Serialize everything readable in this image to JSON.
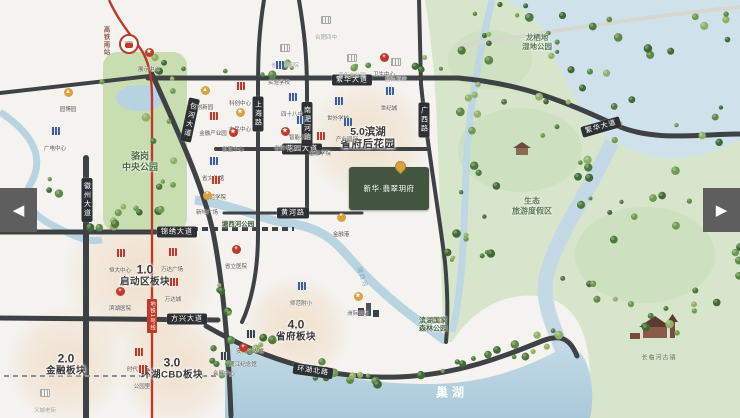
{
  "nav": {
    "prev": "◀",
    "next": "▶"
  },
  "map": {
    "sections": {
      "s1": {
        "num": "1.0",
        "name": "启动区板块"
      },
      "s2": {
        "num": "2.0",
        "name": "金融板块"
      },
      "s3": {
        "num": "3.0",
        "name": "环湖CBD板块"
      },
      "s4": {
        "num": "4.0",
        "name": "省府板块"
      },
      "s5": {
        "num": "5.0滨湖",
        "name": "省府后花园"
      }
    },
    "roads": {
      "fanhua": "繁华大道",
      "huayuan": "花园大道",
      "huanghe": "黄河路",
      "jinxiu": "锦绣大道",
      "fangxing": "方兴大道",
      "huanhubei": "环湖北路",
      "huizhou": "徽州大道",
      "baohe": "包河大道",
      "shanghai": "上海路",
      "nanfeihe": "南淝河路",
      "guangxi": "广西路"
    },
    "metro": {
      "station": "高铁南站",
      "line": "地铁1号线"
    },
    "water": {
      "lake": "巢湖",
      "river": "塘西河"
    },
    "places": {
      "park1a": "骆岗",
      "park1b": "中央公园",
      "park2": "塘西河公园",
      "wet1": "龙栖地",
      "wet2": "湿地公园",
      "forest1": "滨湖国家",
      "forest2": "森林公园",
      "resort1": "生态",
      "resort2": "旅游度假区",
      "town": "长临河古镇"
    },
    "project": {
      "name": "新华·翡翠玥府"
    },
    "colors": {
      "accent_red": "#c0392b",
      "road_dark": "#3f4245",
      "wetland_green": "#d7e6cb",
      "water_blue": "#c3dae6",
      "gold": "#d9a23c"
    },
    "pois": [
      {
        "x": 285,
        "y": 44,
        "type": "gy",
        "label": "省妇幼医院"
      },
      {
        "x": 326,
        "y": 16,
        "type": "gy",
        "label": "合肥四中"
      },
      {
        "x": 352,
        "y": 54,
        "type": "gy",
        "label": "青年创业园"
      },
      {
        "x": 396,
        "y": 58,
        "type": "gy",
        "label": "国际学校"
      },
      {
        "x": 279,
        "y": 61,
        "type": "bb",
        "label": "实验学校"
      },
      {
        "x": 292,
        "y": 93,
        "type": "bb",
        "label": "四十八中"
      },
      {
        "x": 300,
        "y": 116,
        "type": "bb",
        "label": "智能小镇"
      },
      {
        "x": 338,
        "y": 97,
        "type": "bb",
        "label": "世外学校"
      },
      {
        "x": 347,
        "y": 118,
        "type": "bb",
        "label": "产业园区"
      },
      {
        "x": 389,
        "y": 87,
        "type": "bb",
        "label": "世纪城"
      },
      {
        "x": 55,
        "y": 127,
        "type": "bb",
        "label": "广电中心"
      },
      {
        "x": 213,
        "y": 157,
        "type": "bb",
        "label": "省文化馆"
      },
      {
        "x": 301,
        "y": 282,
        "type": "bb",
        "label": "师范附小"
      },
      {
        "x": 250,
        "y": 330,
        "type": "db",
        "label": "安徽名人馆"
      },
      {
        "x": 224,
        "y": 352,
        "type": "db",
        "label": "会展中心"
      },
      {
        "x": 240,
        "y": 82,
        "type": "rb",
        "label": "科创中心"
      },
      {
        "x": 213,
        "y": 112,
        "type": "rb",
        "label": "金融产业园"
      },
      {
        "x": 215,
        "y": 176,
        "type": "rb",
        "label": "师范学院"
      },
      {
        "x": 120,
        "y": 249,
        "type": "rb",
        "label": "恒大中心"
      },
      {
        "x": 172,
        "y": 248,
        "type": "rb",
        "label": "万达广场"
      },
      {
        "x": 173,
        "y": 278,
        "type": "rb",
        "label": "万达城"
      },
      {
        "x": 138,
        "y": 348,
        "type": "rb",
        "label": "时代广场"
      },
      {
        "x": 142,
        "y": 365,
        "type": "rb",
        "label": "公园里"
      },
      {
        "x": 320,
        "y": 132,
        "type": "rb",
        "label": "金融学院"
      },
      {
        "x": 68,
        "y": 88,
        "type": "gf",
        "label": "园博园"
      },
      {
        "x": 205,
        "y": 86,
        "type": "gf",
        "label": "创新园"
      },
      {
        "x": 240,
        "y": 108,
        "type": "gs",
        "label": "市民中心"
      },
      {
        "x": 233,
        "y": 128,
        "type": "rs",
        "label": "省直中心"
      },
      {
        "x": 285,
        "y": 127,
        "type": "rs",
        "label": "省府中心"
      },
      {
        "x": 149,
        "y": 48,
        "type": "rs",
        "label": "展示中心"
      },
      {
        "x": 341,
        "y": 213,
        "type": "gg",
        "label": "金融港"
      },
      {
        "x": 207,
        "y": 191,
        "type": "gg",
        "label": "新地广场"
      },
      {
        "x": 358,
        "y": 292,
        "type": "gs",
        "label": "洲际酒店"
      },
      {
        "x": 120,
        "y": 287,
        "type": "rc",
        "label": "滨湖医院"
      },
      {
        "x": 236,
        "y": 245,
        "type": "rc",
        "label": "省立医院"
      },
      {
        "x": 384,
        "y": 53,
        "type": "rc",
        "label": "卫生中心"
      },
      {
        "x": 45,
        "y": 389,
        "type": "gy",
        "label": "义城老街"
      },
      {
        "x": 243,
        "y": 343,
        "type": "rc",
        "label": "渡江纪念馆"
      }
    ]
  }
}
